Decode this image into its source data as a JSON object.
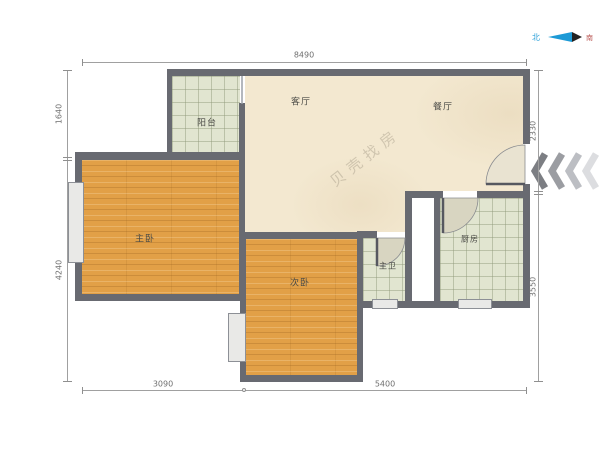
{
  "title": "户型图",
  "compass": {
    "north": "北",
    "south": "南"
  },
  "watermark": "贝壳找房",
  "rooms": [
    {
      "id": "balcony",
      "label": "阳台"
    },
    {
      "id": "living-room",
      "label": "客厅"
    },
    {
      "id": "dining-room",
      "label": "餐厅"
    },
    {
      "id": "master-bedroom",
      "label": "主卧"
    },
    {
      "id": "second-bedroom",
      "label": "次卧"
    },
    {
      "id": "master-bath",
      "label": "主卫"
    },
    {
      "id": "kitchen",
      "label": "厨房"
    }
  ],
  "dimensions": {
    "top": "8490",
    "left_upper": "1640",
    "left_lower": "4240",
    "right_upper": "2330",
    "right_lower": "3550",
    "bottom_left": "3090",
    "bottom_right": "5400"
  },
  "colors": {
    "wall": "#686a71",
    "wood_floor": "#e2a047",
    "tile_floor": "#e1e5d0",
    "marble_floor": "#f3e8d0",
    "dimension_line": "#a0a0a0",
    "chevrons": [
      "#7c7e83",
      "#9b9da2",
      "#bcbec3",
      "#dcdde0"
    ],
    "compass_north": "#2aa0d8",
    "compass_south": "#b95552"
  }
}
